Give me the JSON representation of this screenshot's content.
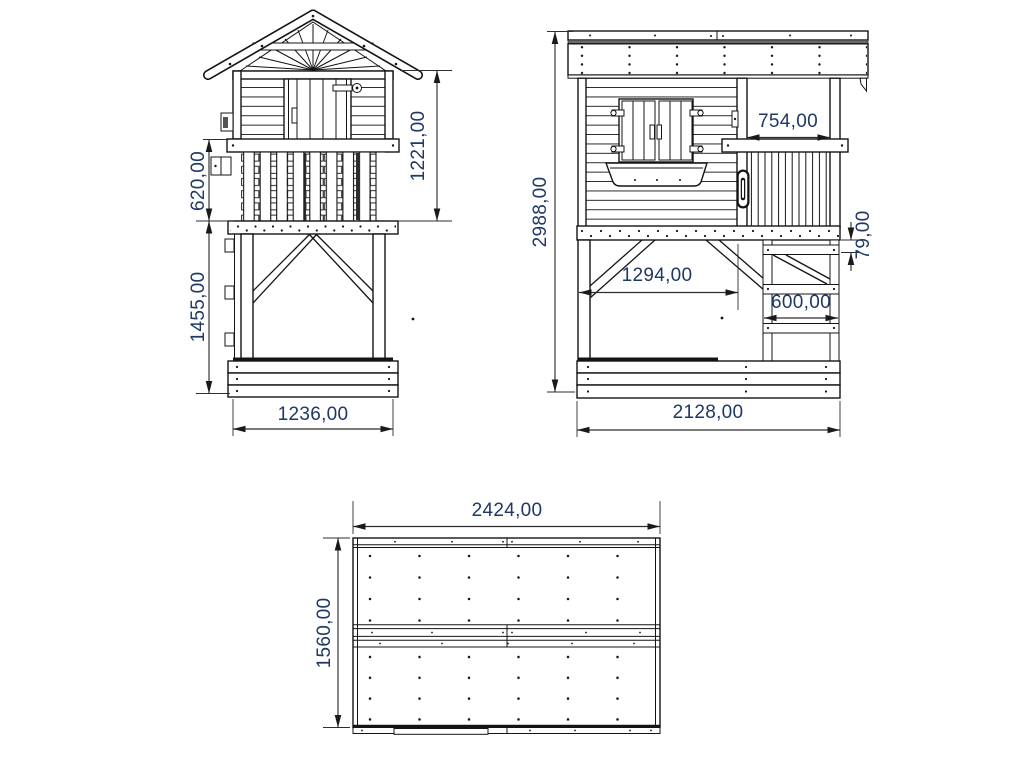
{
  "drawing": {
    "type": "technical-drawing-playhouse",
    "views": {
      "side": {
        "name": "side elevation",
        "dims": {
          "rail_height": "620,00",
          "lower_height": "1455,00",
          "upper_height": "1221,00",
          "width": "1236,00"
        }
      },
      "front": {
        "name": "front elevation",
        "dims": {
          "total_height": "2988,00",
          "balcony_width": "754,00",
          "rung_gap": "79,00",
          "span": "1294,00",
          "ladder_width": "600,00",
          "width": "2128,00"
        }
      },
      "plan": {
        "name": "roof plan",
        "dims": {
          "length": "2424,00",
          "depth": "1560,00"
        }
      }
    },
    "colors": {
      "line": "#141414",
      "dim_line": "#2e2e2e",
      "dim_text": "#1f3864",
      "roof_shadow": "#6a6a6a",
      "background": "#ffffff"
    }
  }
}
